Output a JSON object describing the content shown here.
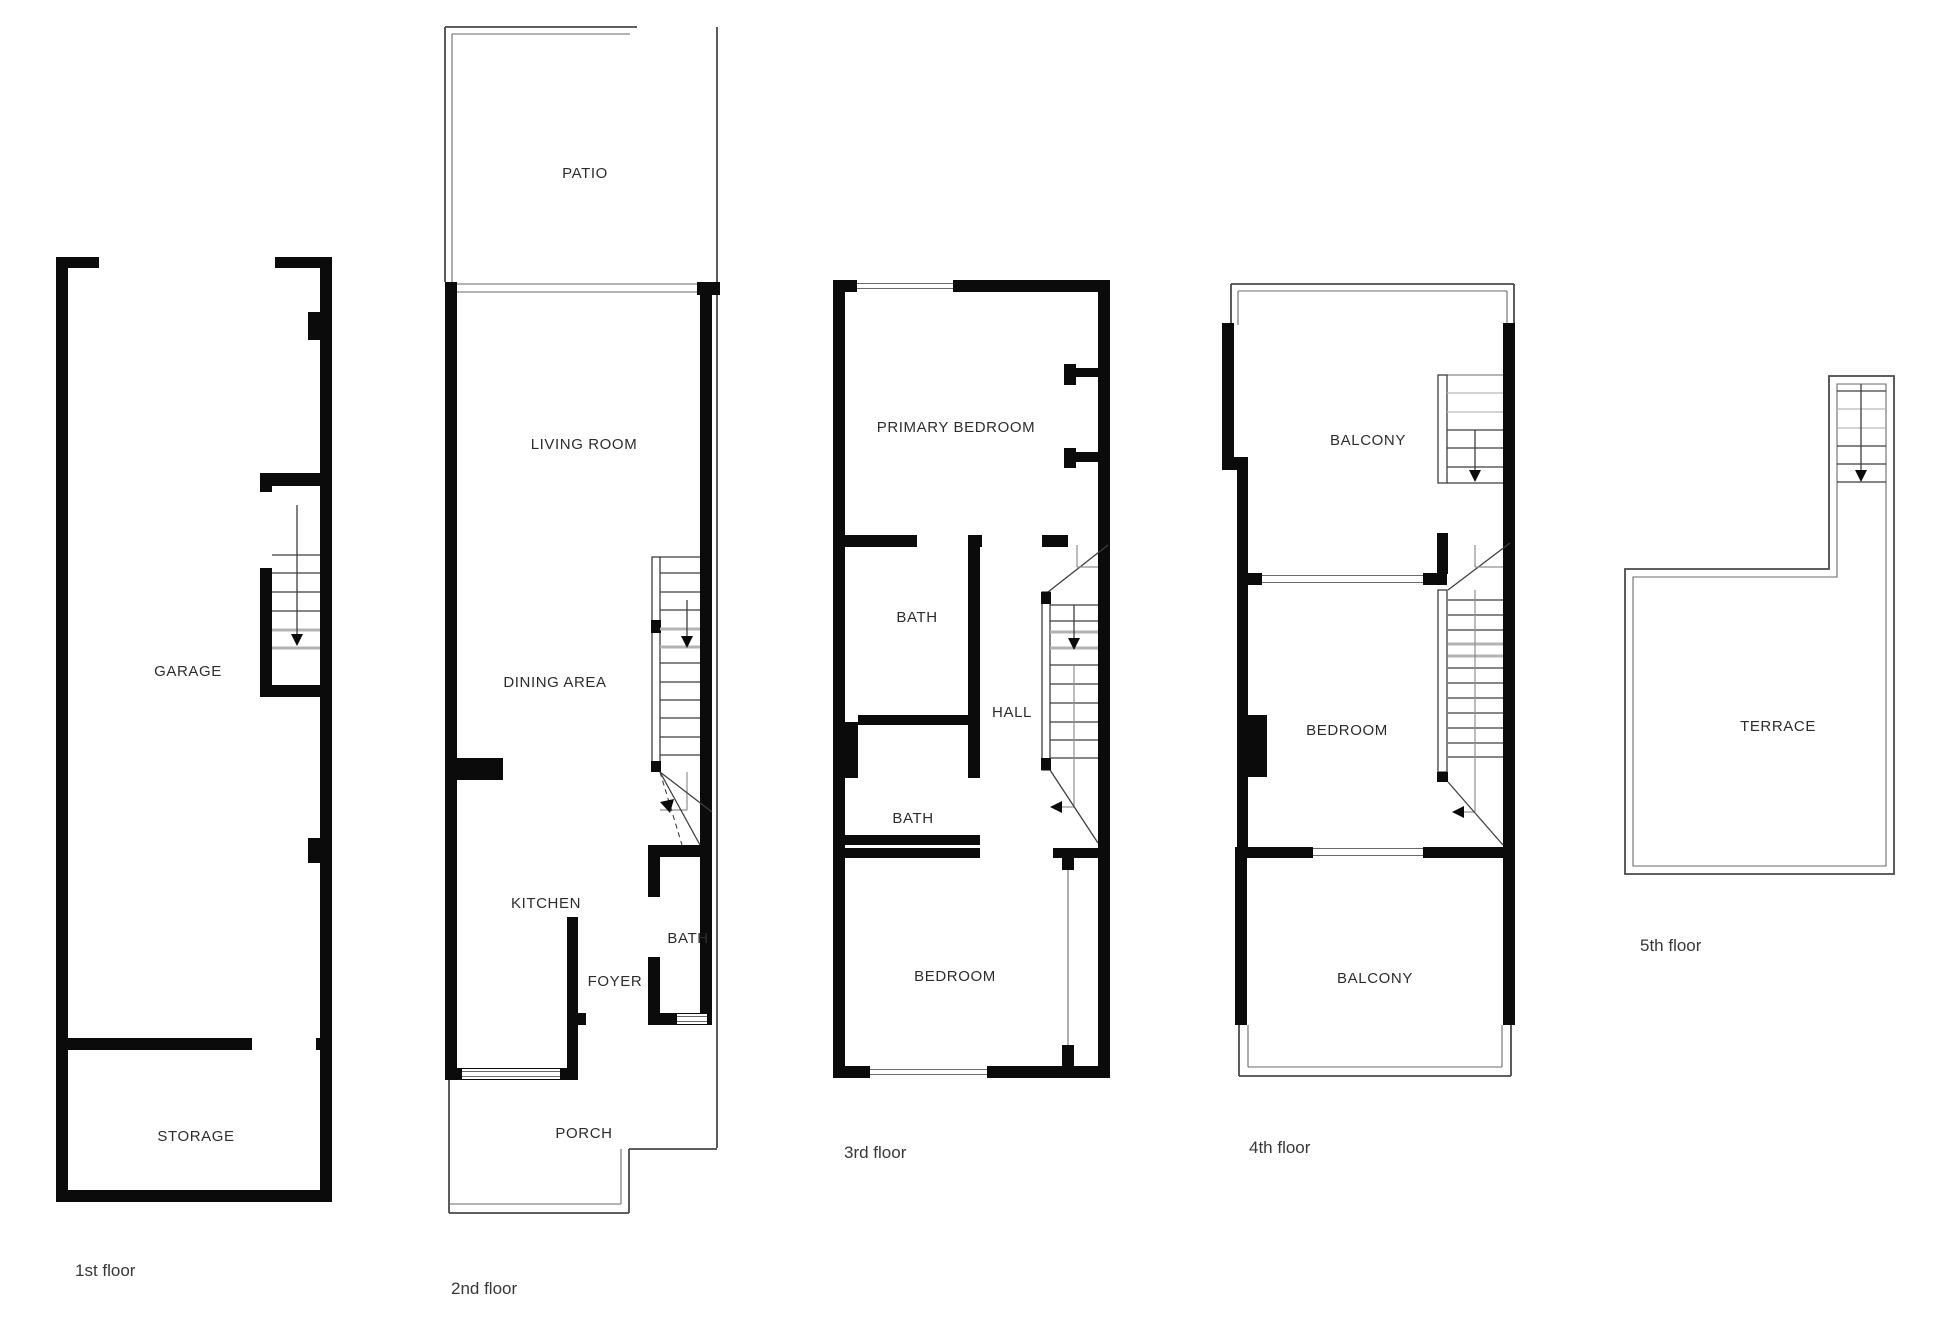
{
  "drawing": {
    "kind": "residential floor plan, 5 levels",
    "colors": {
      "background": "#ffffff",
      "wall": "#0b0b0b",
      "stair_tread": "#3f3f3f",
      "break_line": "#b3b3b3",
      "thin_outline": "#4a4a4a",
      "label_text": "#2d2d2d",
      "caption_text": "#383838"
    }
  },
  "floors": [
    {
      "caption": "1st floor",
      "rooms": [
        {
          "label": "GARAGE"
        },
        {
          "label": "STORAGE"
        }
      ]
    },
    {
      "caption": "2nd floor",
      "rooms": [
        {
          "label": "PATIO"
        },
        {
          "label": "LIVING ROOM"
        },
        {
          "label": "DINING AREA"
        },
        {
          "label": "KITCHEN"
        },
        {
          "label": "FOYER"
        },
        {
          "label": "BATH"
        },
        {
          "label": "PORCH"
        }
      ]
    },
    {
      "caption": "3rd floor",
      "rooms": [
        {
          "label": "PRIMARY BEDROOM"
        },
        {
          "label": "BATH"
        },
        {
          "label": "HALL"
        },
        {
          "label": "BATH"
        },
        {
          "label": "BEDROOM"
        }
      ]
    },
    {
      "caption": "4th floor",
      "rooms": [
        {
          "label": "BALCONY"
        },
        {
          "label": "BEDROOM"
        },
        {
          "label": "BALCONY"
        }
      ]
    },
    {
      "caption": "5th floor",
      "rooms": [
        {
          "label": "TERRACE"
        }
      ]
    }
  ]
}
